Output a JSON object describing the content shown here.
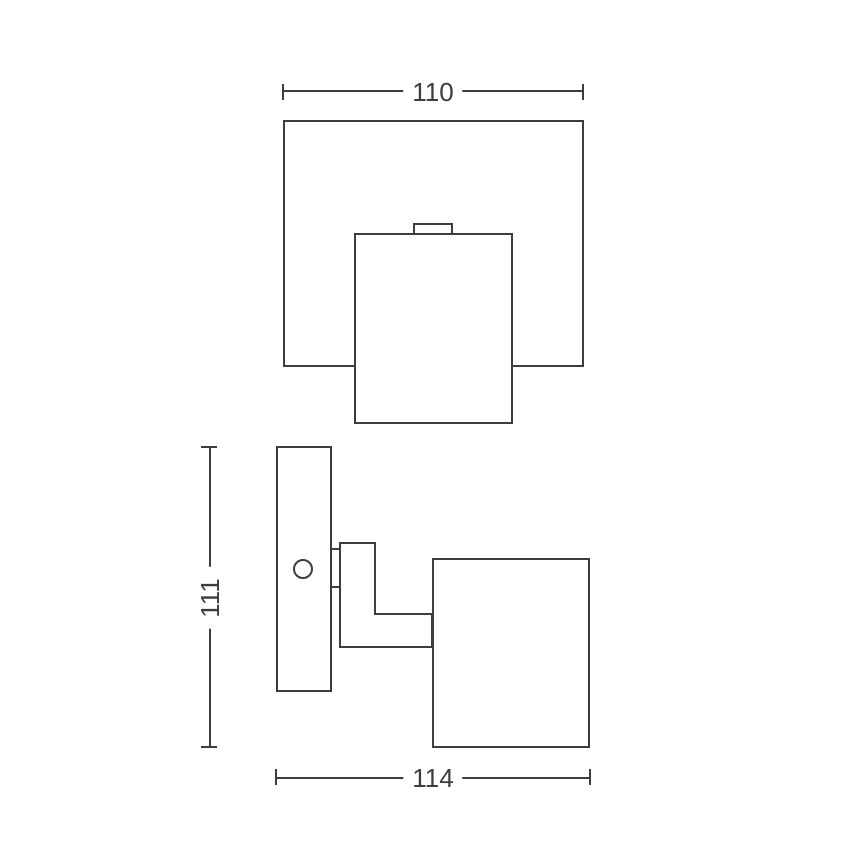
{
  "drawing": {
    "dimensions": {
      "top_width": "110",
      "side_height": "111",
      "bottom_width": "114"
    },
    "colors": {
      "line": "#3d3d3d",
      "background": "#ffffff"
    }
  }
}
